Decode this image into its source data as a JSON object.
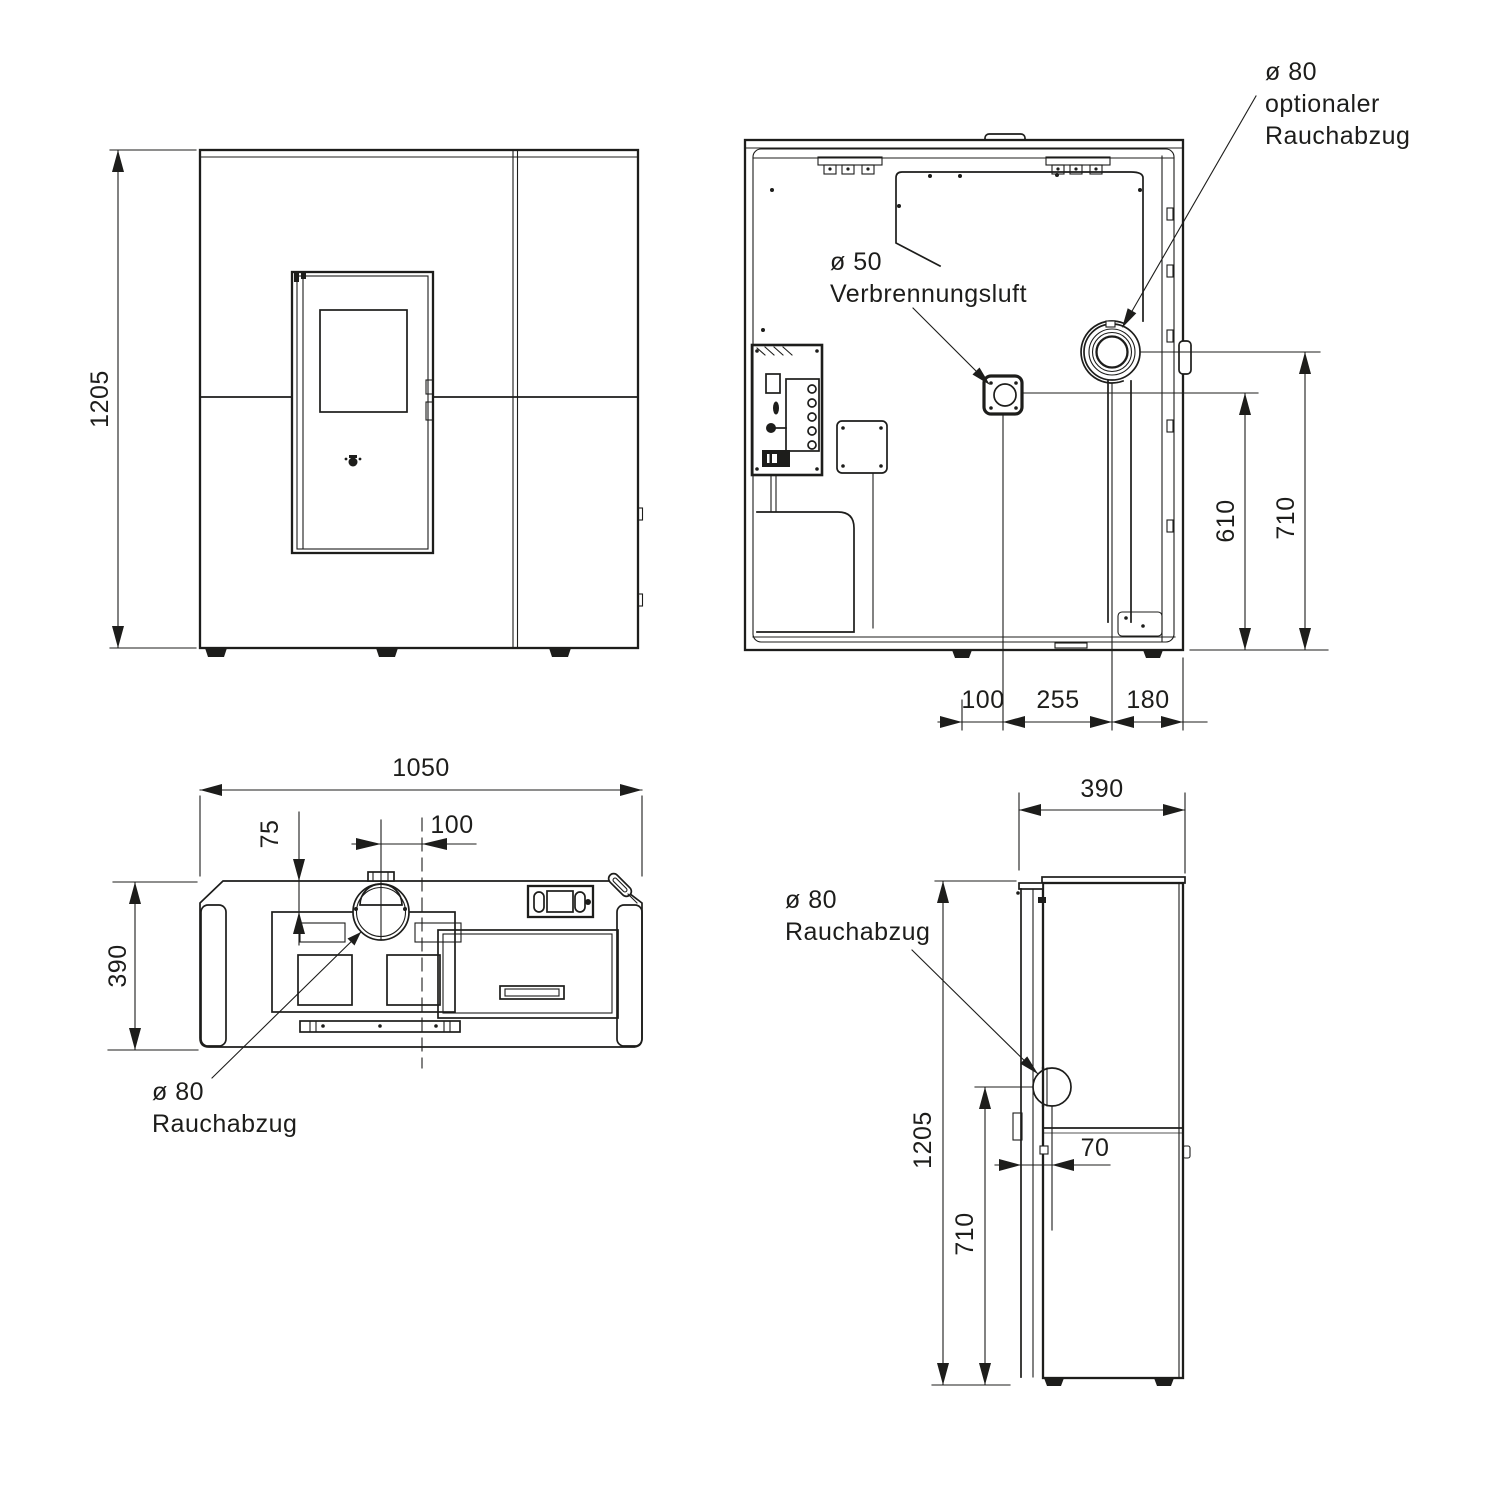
{
  "drawing": {
    "type": "technical-dimension-drawing",
    "unit": "mm",
    "colors": {
      "line": "#1d1d1b",
      "background": "#ffffff"
    }
  },
  "front": {
    "dim_height": "1205"
  },
  "back": {
    "label_air_diameter": "ø 50",
    "label_air_name": "Verbrennungsluft",
    "label_flue_diameter": "ø 80",
    "label_flue_line2": "optionaler",
    "label_flue_line3": "Rauchabzug",
    "dim_center_to_air": "100",
    "dim_air_to_flue": "255",
    "dim_flue_to_edge": "180",
    "dim_air_height": "610",
    "dim_flue_height": "710"
  },
  "top": {
    "dim_width": "1050",
    "dim_flue_offset_back": "75",
    "dim_flue_offset_center": "100",
    "dim_depth": "390",
    "label_flue_diameter": "ø 80",
    "label_flue_name": "Rauchabzug"
  },
  "side": {
    "dim_depth": "390",
    "dim_height": "1205",
    "dim_flue_offset_back": "70",
    "dim_flue_height": "710",
    "label_flue_diameter": "ø 80",
    "label_flue_name": "Rauchabzug"
  }
}
